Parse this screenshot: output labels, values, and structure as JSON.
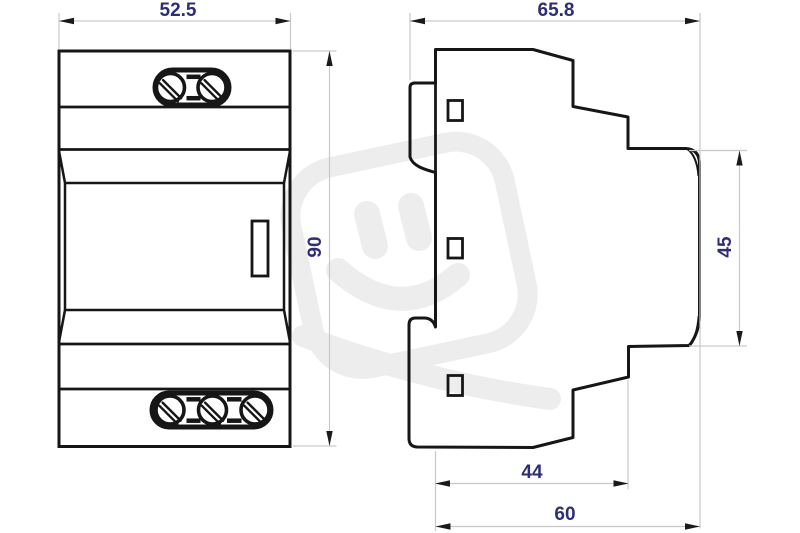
{
  "figure": {
    "type": "technical-drawing",
    "description": "Two-view dimensioned outline drawing of a DIN-rail mounted electrical module (front view and side profile) with grey watermark logo"
  },
  "views": {
    "front": {
      "width_label": "52.5",
      "height_label": "90"
    },
    "side": {
      "depth_label": "65.8",
      "front_height_label": "45",
      "lower_depth_label": "44",
      "total_depth_label": "60"
    }
  },
  "watermark": {
    "icon": "plug-smiley-logo"
  },
  "colors": {
    "background": "#ffffff",
    "outline": "#161616",
    "dimension_line": "#c9c9c9",
    "arrowhead": "#1a1a1a",
    "dimension_text": "#2e2e78",
    "watermark": "#ededed"
  }
}
